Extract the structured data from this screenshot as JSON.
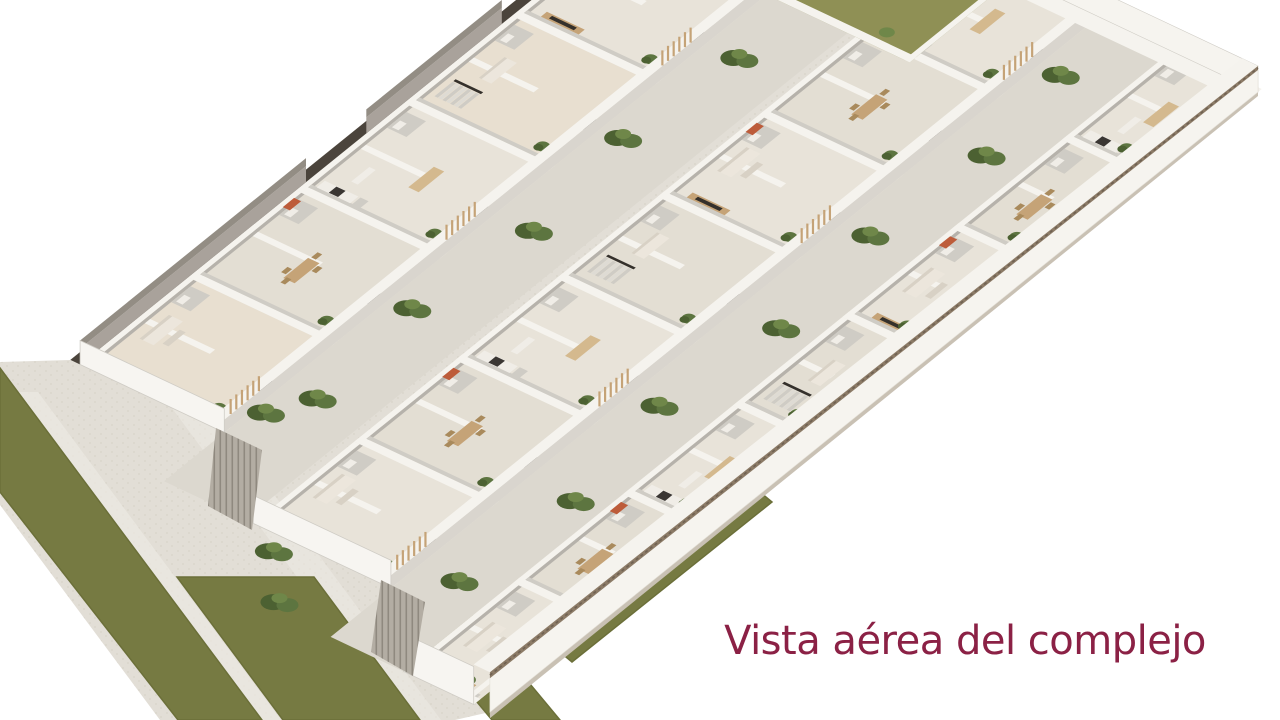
{
  "title": {
    "text": "Vista aérea del complejo",
    "color": "#8b2145"
  },
  "render": {
    "type": "isometric-aerial-cutaway",
    "subject": "residential complex with furnished apartment rows, paved walkways, hedges and lawn strips"
  },
  "palette": {
    "background": "#ffffff",
    "pavement": "#e2ded6",
    "pavement_dot": "#cfcabf",
    "pale_band": "#edeae3",
    "walkway": "#dcd8cf",
    "grass": "#767a42",
    "grass_edge": "#6b6f39",
    "garden": "#8f9055",
    "floor": "#e8e3d9",
    "floor_alt": "#e3ded3",
    "floor_warm": "#e8dfd0",
    "wall_white": "#f5f3ee",
    "wall_shadow": "#b6b2ab",
    "wall_mid": "#cfccc5",
    "wall_dark": "#4b443c",
    "wall_face": "#d9d5ce",
    "end_wall": "#f7f5f1",
    "perimeter_face": "#f6f4ef",
    "perimeter_cap": "#8c7b67",
    "perimeter_base": "#c9c1b4",
    "roof": "#a9a29b",
    "roof_dark": "#938d84",
    "wood": "#c5a377",
    "wood_light": "#d4b98e",
    "chair": "#a98a5c",
    "tv": "#34302b",
    "sofa": "#ece6dc",
    "sofa_shadow": "#d8d1c5",
    "counter": "#f0ede7",
    "appliance": "#3a3633",
    "terracotta": "#bd5c3a",
    "bush_dark": "#4c6132",
    "bush_mid": "#5d7540",
    "bush_light": "#6f8749",
    "fence": "#b3ada3",
    "fence_line": "#8f897f",
    "stair": "#dedbd4",
    "stair_alt": "#cfccc5"
  }
}
